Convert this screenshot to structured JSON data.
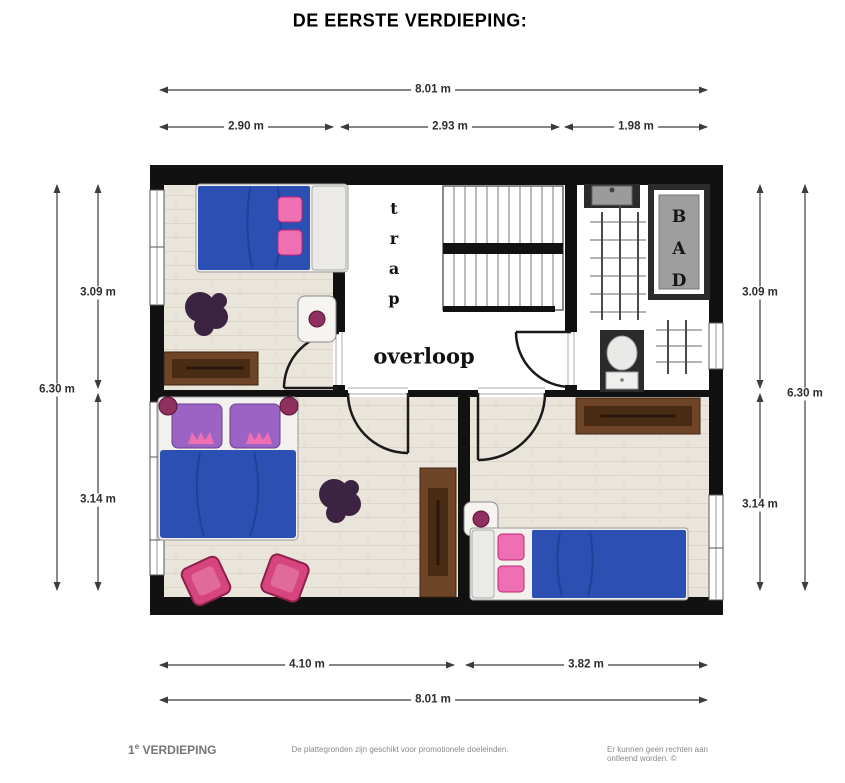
{
  "title": "DE EERSTE VERDIEPING:",
  "colors": {
    "wall": "#111111",
    "bed_blue": "#2b4fb3",
    "bed_blue_fold": "#1d3a8f",
    "pillow_purple": "#9a63c4",
    "pillow_pink": "#ef6fb3",
    "chair_pink": "#d6457e",
    "plant_purple": "#3d2342",
    "wood_brown": "#6e4527",
    "wood_brown_dark": "#4a2c15",
    "tile_dark": "#2b2b2b",
    "tub_gray": "#9e9e9e",
    "knob_maroon": "#8e2f5e",
    "dim_line": "#3c3c3c"
  },
  "rooms": {
    "stairs_label": "trap",
    "landing_label": "overloop",
    "bath_label": "BAD"
  },
  "dimensions": {
    "top_total": "8.01 m",
    "top_segments": [
      "2.90 m",
      "2.93 m",
      "1.98 m"
    ],
    "left_total": "6.30 m",
    "left_segments": [
      "3.09 m",
      "3.14 m"
    ],
    "right_total": "6.30 m",
    "right_segments": [
      "3.09 m",
      "3.14 m"
    ],
    "bottom_segments": [
      "4.10 m",
      "3.82 m"
    ],
    "bottom_total": "8.01 m"
  },
  "footer": {
    "floor_number": "1",
    "floor_sup": "e",
    "floor_label": " VERDIEPING",
    "center_note": "De plattegronden zijn geschikt voor promotionele doeleinden.",
    "right_note": "Er kunnen geen rechten aan ontleend worden. ©"
  }
}
